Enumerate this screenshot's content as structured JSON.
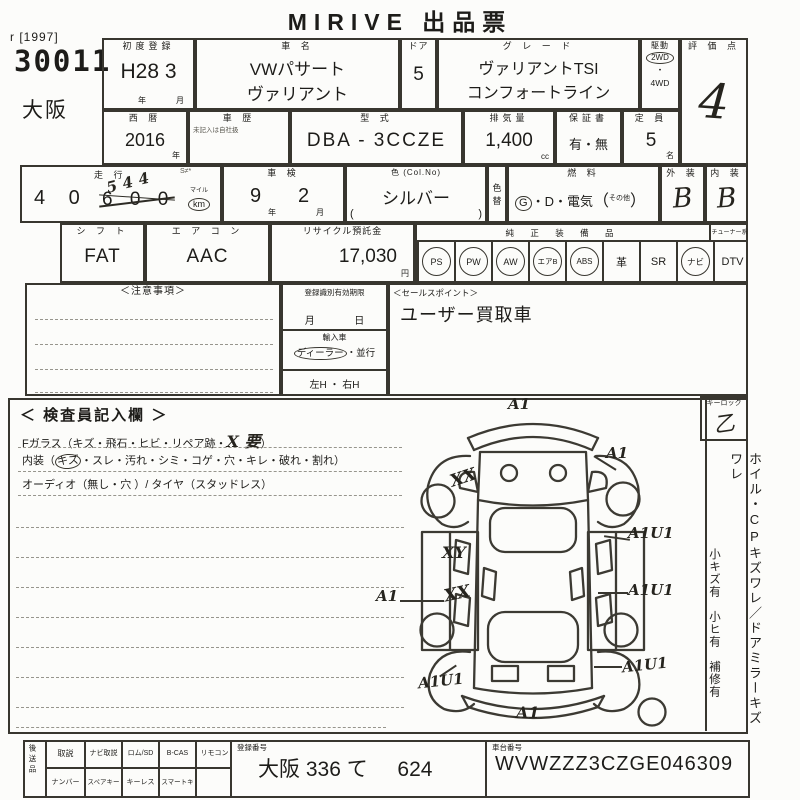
{
  "title": "MIRIVE 出品票",
  "corner": {
    "ref": "r [1997]",
    "lot": "30011",
    "venue": "大阪"
  },
  "first_reg": {
    "label": "初度登録",
    "value": "H28 3",
    "year": "年",
    "month": "月"
  },
  "car_name": {
    "label": "車  名",
    "line1": "VWパサート",
    "line2": "ヴァリアント"
  },
  "doors": {
    "label": "ドア",
    "value": "5"
  },
  "grade": {
    "label": "グ レ ー ド",
    "line1": "ヴァリアントTSI",
    "line2": "コンフォートライン"
  },
  "drive": {
    "label": "駆動",
    "opt1": "2WD",
    "dot": "・",
    "opt2": "4WD"
  },
  "score": {
    "label": "評 価 点",
    "value": "4"
  },
  "year_west": {
    "label": "西 暦",
    "value": "2016",
    "unit": "年"
  },
  "history": {
    "label": "車 歴",
    "note": "未記入は自社扱"
  },
  "model_code": {
    "label": "型  式",
    "value": "DBA - 3CCZE"
  },
  "displacement": {
    "label": "排気量",
    "value": "1,400",
    "unit": "cc"
  },
  "warranty": {
    "label": "保証書",
    "value": "有・無"
  },
  "capacity": {
    "label": "定 員",
    "value": "5",
    "unit": "名"
  },
  "mileage": {
    "label": "走 行",
    "note": "S≠*",
    "digits": "4 0",
    "struck": "6 0 0",
    "corrected": "544",
    "mile": "マイル",
    "km": "km"
  },
  "inspection": {
    "label": "車  検",
    "year_v": "9",
    "year_u": "年",
    "month_v": "2",
    "month_u": "月"
  },
  "color": {
    "label": "色 (Col.No)",
    "value": "シルバー",
    "paren_l": "(",
    "paren_r": ")"
  },
  "color_change": {
    "label": "色替"
  },
  "fuel": {
    "label": "燃  料",
    "g": "G",
    "rest": "・D・電気",
    "paren_l": "（",
    "other": "その他",
    "paren_r": "）"
  },
  "exterior": {
    "label": "外 装",
    "value": "B"
  },
  "interior": {
    "label": "内 装",
    "value": "B"
  },
  "shift": {
    "label": "シ フ ト",
    "value": "FAT"
  },
  "aircon": {
    "label": "エ ア コ ン",
    "value": "AAC"
  },
  "recycle": {
    "label": "リサイクル預託金",
    "value": "17,030",
    "unit": "円"
  },
  "equipment": {
    "label": "純 正 装 備 品",
    "tuner": "チューナー系",
    "items": [
      {
        "label": "PS",
        "circled": true
      },
      {
        "label": "PW",
        "circled": true
      },
      {
        "label": "AW",
        "circled": true
      },
      {
        "label": "エアB",
        "circled": true
      },
      {
        "label": "ABS",
        "circled": true
      },
      {
        "label": "革",
        "circled": false
      },
      {
        "label": "SR",
        "circled": false
      },
      {
        "label": "ナビ",
        "circled": true
      },
      {
        "label": "DTV",
        "circled": false
      }
    ]
  },
  "notes": {
    "label": "＜注意事項＞"
  },
  "validity": {
    "label": "登録識別有効期限",
    "month": "月",
    "day": "日"
  },
  "import_car": {
    "label": "輸入車",
    "dealer": "ディーラー",
    "sep": "・",
    "parallel": "並行"
  },
  "handle": {
    "value": "左H ・ 右H"
  },
  "sales": {
    "label": "＜セールスポイント＞",
    "value": "ユーザー買取車"
  },
  "inspector": {
    "label": "＜ 検査員記入欄 ＞",
    "l1a": "Fガラス（キズ・飛石・ヒビ・リペア跡・",
    "l1hw": "X 要",
    "l1b": "）",
    "l2a": "内装（",
    "l2circ": "キズ",
    "l2b": "・スレ・汚れ・シミ・コゲ・穴・キレ・破れ・割れ）",
    "l3": "オーディオ（無し・穴 ）/ タイヤ（スタッドレス）"
  },
  "keylock": {
    "label": "キーロック",
    "mark": "乙"
  },
  "side_notes": {
    "main": "ホイル・CPキズワレ／ドアミラーキズ　ワレ",
    "sub": "小キズ有　小ヒ有　補修有"
  },
  "diagram": {
    "marks": [
      "A1",
      "A1",
      "XX",
      "XY",
      "A1U1",
      "A1",
      "XX",
      "A1U1",
      "A1U1",
      "A1U1",
      "A1"
    ]
  },
  "shipping": {
    "label": "後送品",
    "row1": [
      "取説",
      "ナビ取説",
      "ロム/SD",
      "B-CAS",
      "リモコン"
    ],
    "row2": [
      "ナンバー",
      "スペアキー",
      "キーレス",
      "スマートキー",
      ""
    ]
  },
  "reg_no": {
    "label": "登録番号",
    "value1": "大阪 336 て",
    "value2": "624"
  },
  "chassis": {
    "label": "車台番号",
    "value": "WVWZZZ3CZGE046309"
  }
}
